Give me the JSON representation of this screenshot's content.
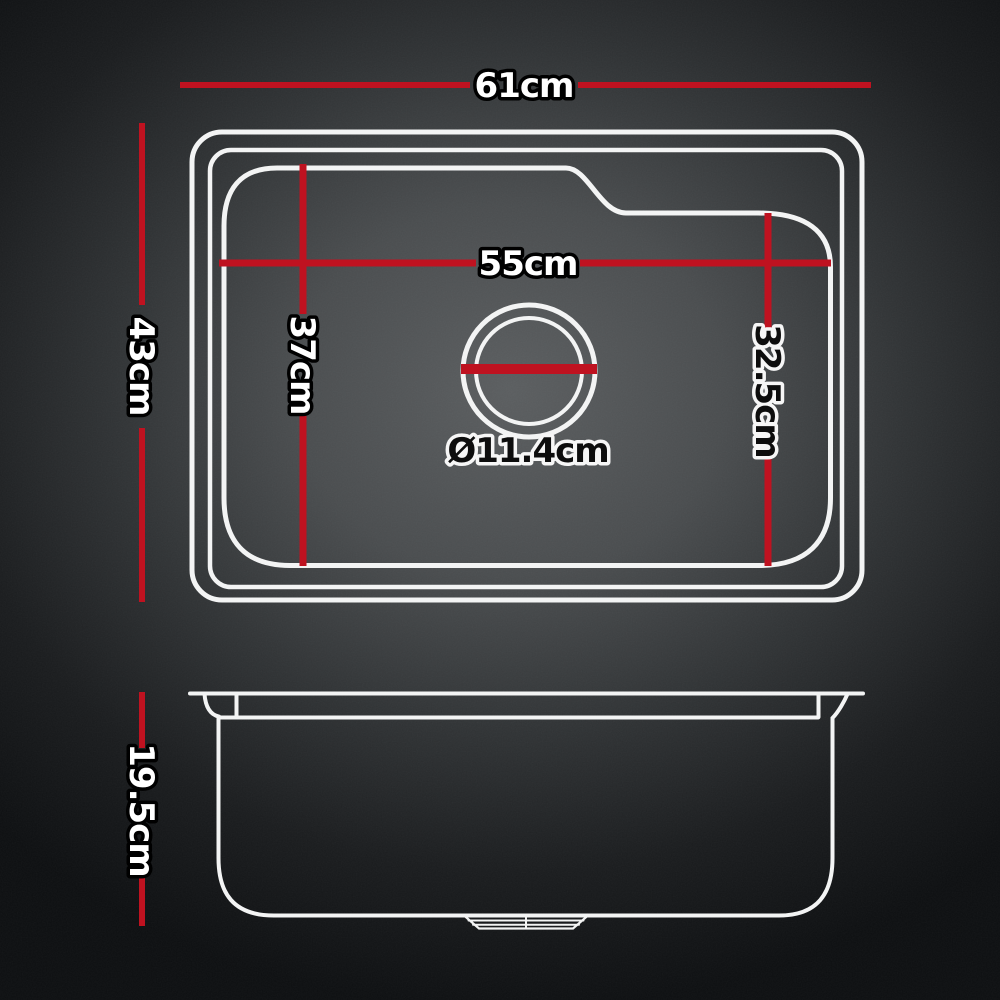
{
  "meta": {
    "description": "Kitchen sink dimension diagram with top view and side view"
  },
  "colors": {
    "dimension_line": "#bf1220",
    "outline": "#f3f4f4",
    "background_center": "#5b5e60",
    "background_edge": "#0d0f11",
    "label_light_fill": "#ffffff",
    "label_light_outline": "#000000",
    "label_dark_fill": "#0d0d0d",
    "label_dark_outline": "#f6f6f6"
  },
  "labels": {
    "overall_width": "61cm",
    "overall_depth": "43cm",
    "bowl_width": "55cm",
    "bowl_depth_left": "37cm",
    "bowl_depth_right": "32.5cm",
    "drain_diameter": "Ø11.4cm",
    "bowl_height": "19.5cm"
  },
  "measurements": [
    {
      "name": "overall width (top view)",
      "value": 61,
      "unit": "cm"
    },
    {
      "name": "overall depth (top view)",
      "value": 43,
      "unit": "cm"
    },
    {
      "name": "bowl width",
      "value": 55,
      "unit": "cm"
    },
    {
      "name": "bowl depth left",
      "value": 37,
      "unit": "cm"
    },
    {
      "name": "bowl depth right",
      "value": 32.5,
      "unit": "cm"
    },
    {
      "name": "drain diameter",
      "value": 11.4,
      "unit": "cm"
    },
    {
      "name": "bowl height (side view)",
      "value": 19.5,
      "unit": "cm"
    }
  ]
}
